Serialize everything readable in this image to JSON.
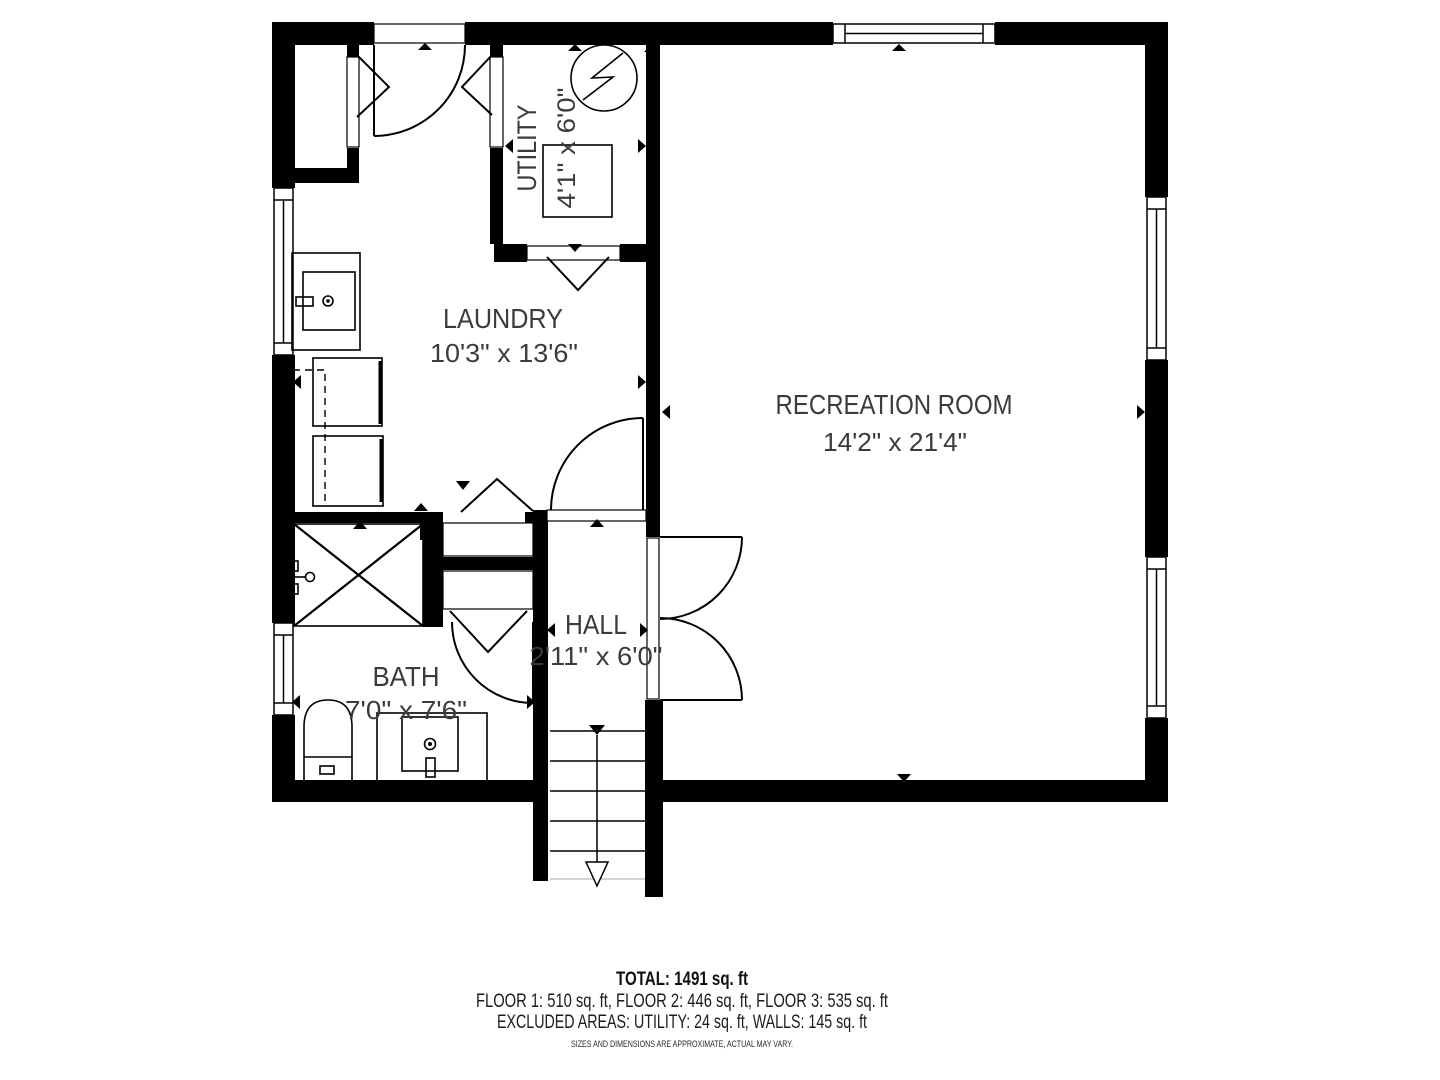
{
  "colors": {
    "walls": "#000000",
    "background": "#ffffff",
    "label_text": "#3b3b3b",
    "footer_text": "#111111"
  },
  "rooms": {
    "utility": {
      "name": "UTILITY",
      "dims": "4'1\" x 6'0\""
    },
    "laundry": {
      "name": "LAUNDRY",
      "dims": "10'3\" x 13'6\""
    },
    "recreation": {
      "name": "RECREATION ROOM",
      "dims": "14'2\" x 21'4\""
    },
    "hall": {
      "name": "HALL",
      "dims": "2'11\" x 6'0\""
    },
    "bath": {
      "name": "BATH",
      "dims": "7'0\" x 7'6\""
    }
  },
  "footer": {
    "total": "TOTAL: 1491 sq. ft",
    "floors": "FLOOR 1: 510 sq. ft, FLOOR 2: 446 sq. ft, FLOOR 3: 535 sq. ft",
    "excluded": "EXCLUDED AREAS: UTILITY: 24 sq. ft, WALLS: 145 sq. ft",
    "disclaimer": "SIZES AND DIMENSIONS ARE APPROXIMATE, ACTUAL MAY VARY."
  }
}
